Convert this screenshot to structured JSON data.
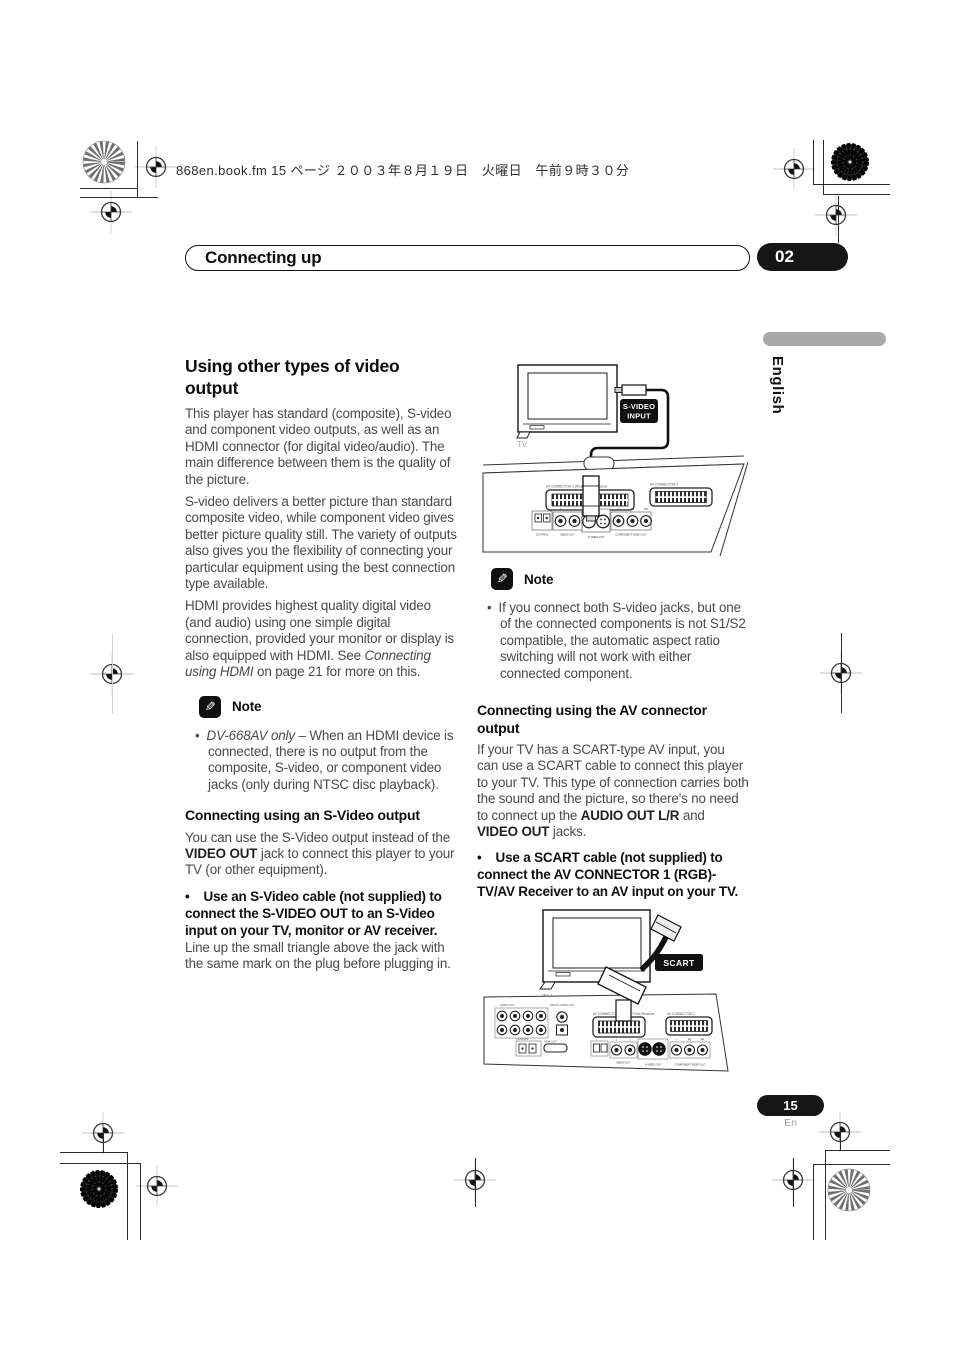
{
  "page": {
    "header_line": "868en.book.fm  15 ページ  ２００３年８月１９日　火曜日　午前９時３０分",
    "chapter_title": "Connecting up",
    "chapter_number": "02",
    "language_tab": "English",
    "page_number": "15",
    "page_number_sub": "En"
  },
  "glyphs": {
    "bullet": "•",
    "pencil": "✎"
  },
  "left": {
    "h1": "Using other types of video output",
    "p1": "This player has standard (composite), S-video and component video outputs, as well as an HDMI connector (for digital video/audio). The main difference between them is the quality of the picture.",
    "p2": "S-video delivers a better picture than standard composite video, while component video gives better picture quality still. The variety of outputs also gives you the flexibility of connecting your particular equipment using the best connection type available.",
    "p3a": "HDMI provides highest quality digital video (and audio) using one simple digital connection, provided your monitor or display is also equipped with HDMI. See ",
    "p3b": "Connecting using HDMI",
    "p3c": " on page 21 for more on this.",
    "note_label": "Note",
    "nb_a": "DV-668AV only",
    "nb_b": " – When an HDMI device is connected, there is no output from the composite, S-video, or component video jacks (only during NTSC disc playback).",
    "h2": "Connecting using an S-Video output",
    "p4a": "You can use the S-Video output instead of the ",
    "p4b": "VIDEO OUT",
    "p4c": " jack to connect this player to your TV (or other equipment).",
    "b1": "Use an S-Video cable (not supplied) to connect the S-VIDEO OUT to an S-Video input on your TV, monitor or AV receiver.",
    "p5": "Line up the small triangle above the jack with the same mark on the plug before plugging in."
  },
  "right": {
    "note_label": "Note",
    "nb": "If you connect both S-video jacks, but one of the connected components is not S1/S2 compatible, the automatic aspect ratio switching will not work with either connected component.",
    "h2": "Connecting using the AV connector output",
    "p1a": "If your TV has a SCART-type AV input, you can use a SCART cable to connect this player to your TV. This type of connection carries both the sound and the picture, so there's no need to connect up the ",
    "p1b": "AUDIO OUT L/R",
    "p1c": " and ",
    "p1d": "VIDEO OUT",
    "p1e": " jacks.",
    "b1": "Use a SCART cable (not supplied) to connect the AV CONNECTOR 1 (RGB)-TV/AV Receiver to an AV input on your TV."
  },
  "diagram1": {
    "tv": "TV",
    "badge_l1": "S-VIDEO",
    "badge_l2": "INPUT",
    "scart1": "AV CONNECTOR 1 (RGB)-TV/AV Receiver",
    "scart2": "AV CONNECTOR 2",
    "control": "CONTROL",
    "video_out": "VIDEO OUT",
    "svideo_out": "S-VIDEO OUT",
    "component": "COMPONENT VIDEO OUT",
    "n1": "1",
    "n2": "2",
    "y": "Y",
    "pb": "PB",
    "pr": "PR"
  },
  "diagram2": {
    "tv": "TV",
    "badge": "SCART",
    "audio_out": "AUDIO OUT",
    "digital": "DIGITAL AUDIO OUT",
    "control": "CONTROL",
    "hdmi": "HDMI OUT",
    "scart1": "AV CONNECTOR 1 (RGB)-TV/AV Receiver",
    "scart2": "AV CONNECTOR 2",
    "video_out": "VIDEO OUT",
    "svideo_out": "S-VIDEO OUT",
    "component": "COMPONENT VIDEO OUT",
    "n1": "1",
    "n2": "2",
    "y": "Y",
    "pb": "PB",
    "pr": "PR"
  },
  "colors": {
    "ink": "#161616",
    "body_text": "#4a4a4a",
    "muted": "#aaaaaa"
  }
}
